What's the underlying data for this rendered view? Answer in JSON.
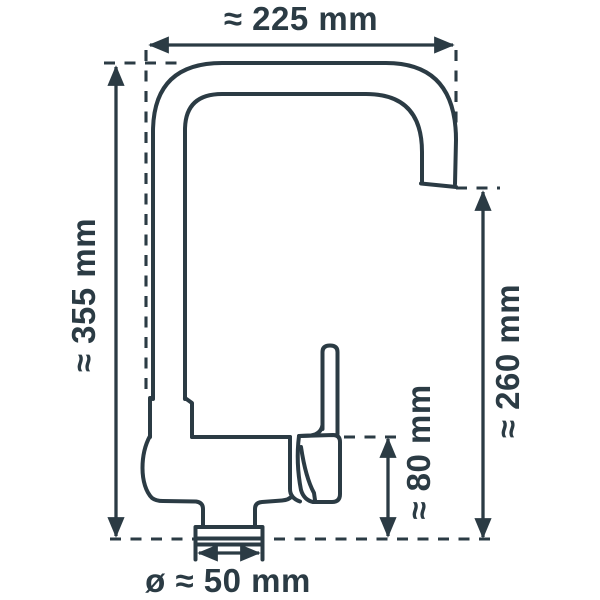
{
  "colors": {
    "line": "#2b3b44",
    "background": "#ffffff"
  },
  "dimensions": {
    "top_width": {
      "label": "≈ 225 mm"
    },
    "overall_height": {
      "label": "≈ 355 mm"
    },
    "spout_height": {
      "label": "≈ 260 mm"
    },
    "body_height": {
      "label": "≈ 80 mm"
    },
    "base_diameter": {
      "label": "ø ≈ 50 mm"
    }
  }
}
